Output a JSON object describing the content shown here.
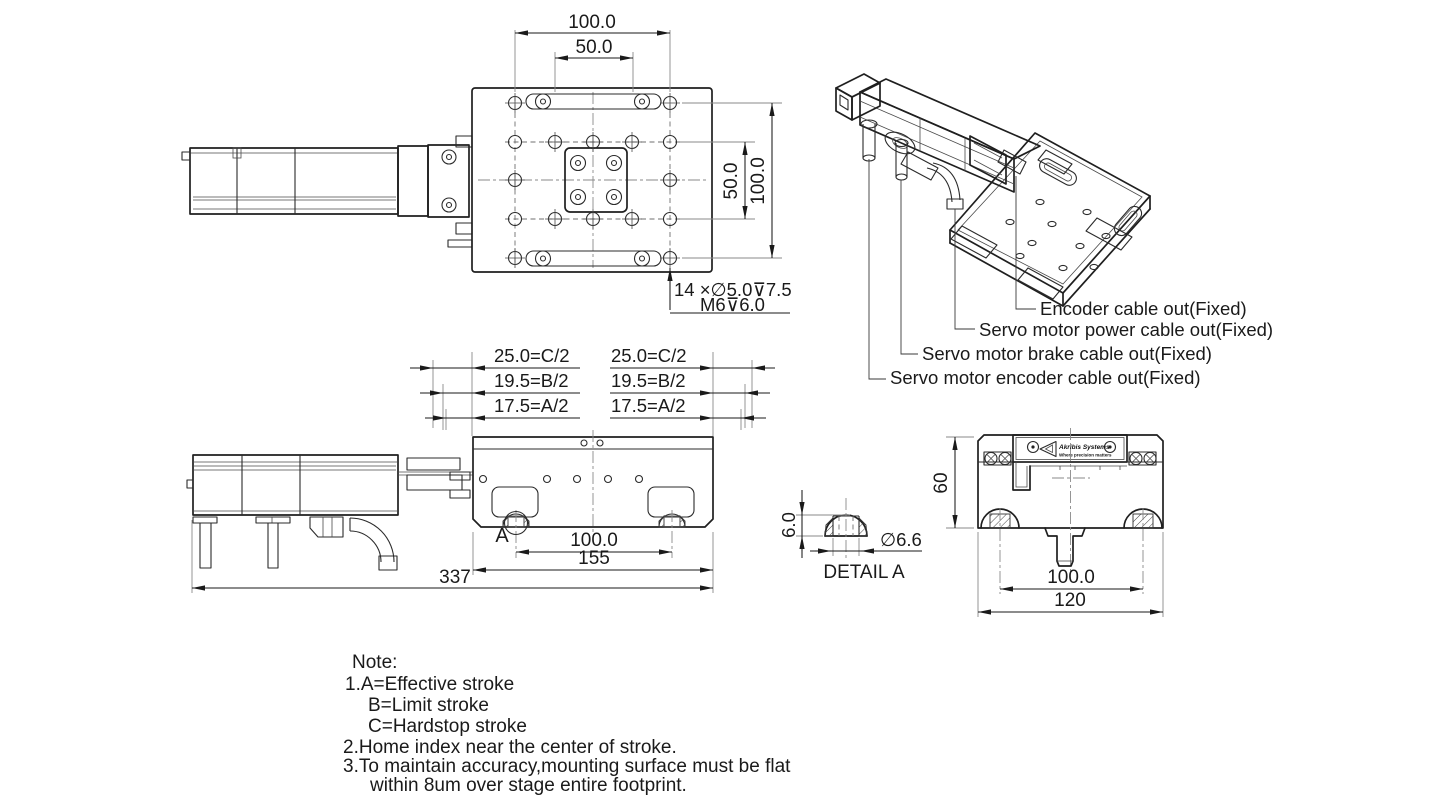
{
  "drawing": {
    "top_view": {
      "dim_width": "100.0",
      "dim_width_inner": "50.0",
      "dim_height_inner": "50.0",
      "dim_height": "100.0",
      "hole_note_1": "14 ×∅5.0⊽7.5",
      "hole_note_2": "M6⊽6.0"
    },
    "stroke_dims": {
      "left": [
        "25.0=C/2",
        "19.5=B/2",
        "17.5=A/2"
      ],
      "right": [
        "25.0=C/2",
        "19.5=B/2",
        "17.5=A/2"
      ]
    },
    "side_view": {
      "dim_hole_pitch": "100.0",
      "dim_table": "155",
      "dim_overall": "337",
      "detail_label": "A"
    },
    "detail_a": {
      "dim_height": "6.0",
      "dim_dia": "∅6.6",
      "title": "DETAIL A"
    },
    "end_view": {
      "dim_height": "60",
      "dim_pitch": "100.0",
      "dim_width": "120",
      "brand": "Akribis Systems",
      "tagline": "Where precision matters"
    },
    "iso_callouts": [
      "Encoder cable out(Fixed)",
      "Servo motor power cable out(Fixed)",
      "Servo motor brake cable out(Fixed)",
      "Servo motor encoder cable out(Fixed)"
    ],
    "notes": [
      "Note:",
      "1.A=Effective stroke",
      "B=Limit stroke",
      "C=Hardstop stroke",
      "2.Home index near the center of stroke.",
      "3.To maintain accuracy,mounting surface must be flat",
      "within 8um over stage entire footprint."
    ]
  },
  "colors": {
    "line": "#1f1f1f",
    "background": "#ffffff"
  }
}
